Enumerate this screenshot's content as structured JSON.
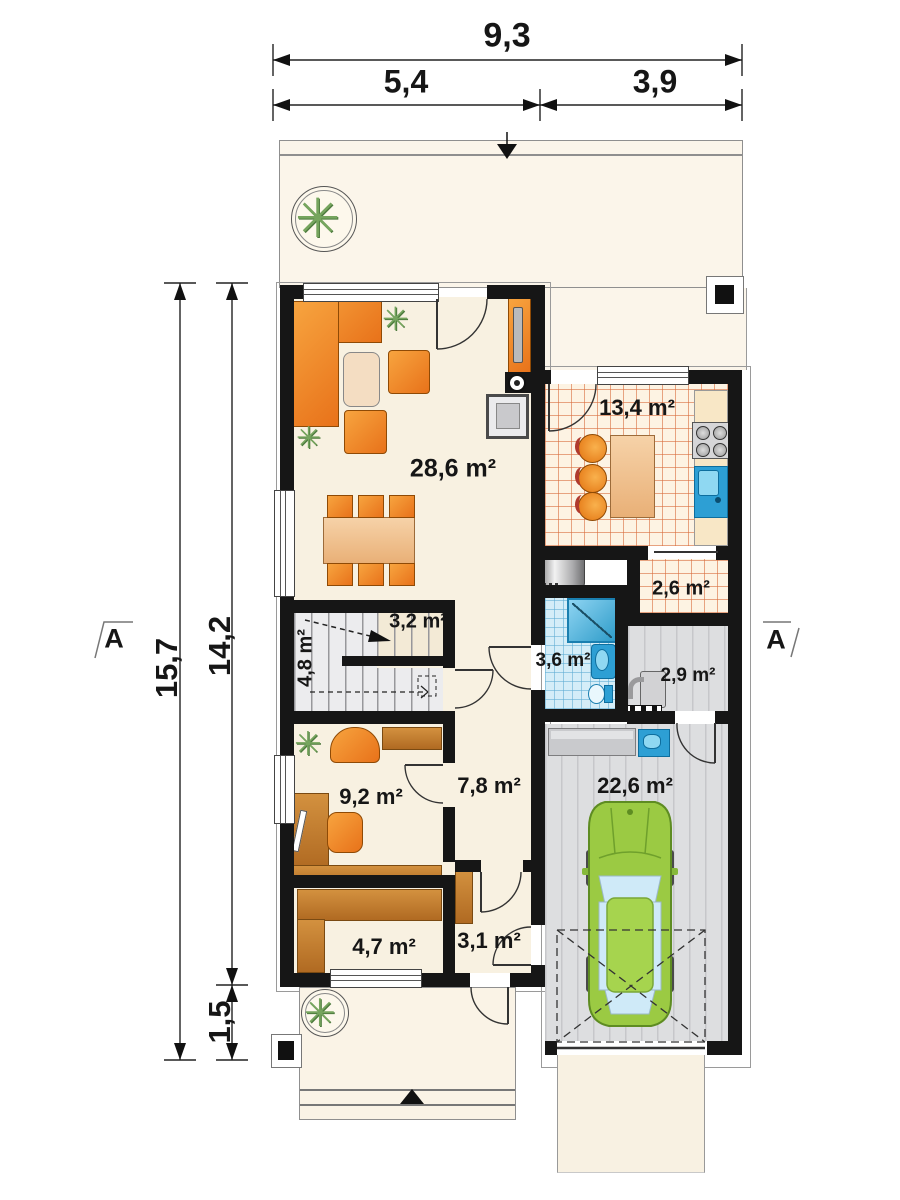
{
  "dimensions": {
    "top_total": "9,3",
    "top_left": "5,4",
    "top_right": "3,9",
    "side_total": "15,7",
    "side_main": "14,2",
    "side_porch": "1,5"
  },
  "markers": {
    "section_left": "A",
    "section_right": "A"
  },
  "rooms": {
    "living": {
      "area": "28,6 m²"
    },
    "kitchen": {
      "area": "13,4 m²"
    },
    "pantry": {
      "area": "2,6 m²"
    },
    "stairs_upper": {
      "area": "3,2 m²"
    },
    "stairs_lower": {
      "area": "4,8 m²"
    },
    "bathroom": {
      "area": "3,6 m²"
    },
    "utility": {
      "area": "2,9 m²"
    },
    "office": {
      "area": "9,2 m²"
    },
    "hall": {
      "area": "7,8 m²"
    },
    "garage": {
      "area": "22,6 m²"
    },
    "wardrobe": {
      "area": "4,7 m²"
    },
    "entry": {
      "area": "3,1 m²"
    }
  },
  "icons": {
    "plant": "✳"
  },
  "colors": {
    "wall": "#161616",
    "floor_cream": "#f8f1e1",
    "accent_orange": "#ef8a1f",
    "wood_brown": "#c9813a",
    "kitchen_tile_line": "#d86d3d",
    "bath_blue": "#2d9fd4",
    "car_green": "#9ccb45",
    "floor_gray": "#dddee0"
  }
}
